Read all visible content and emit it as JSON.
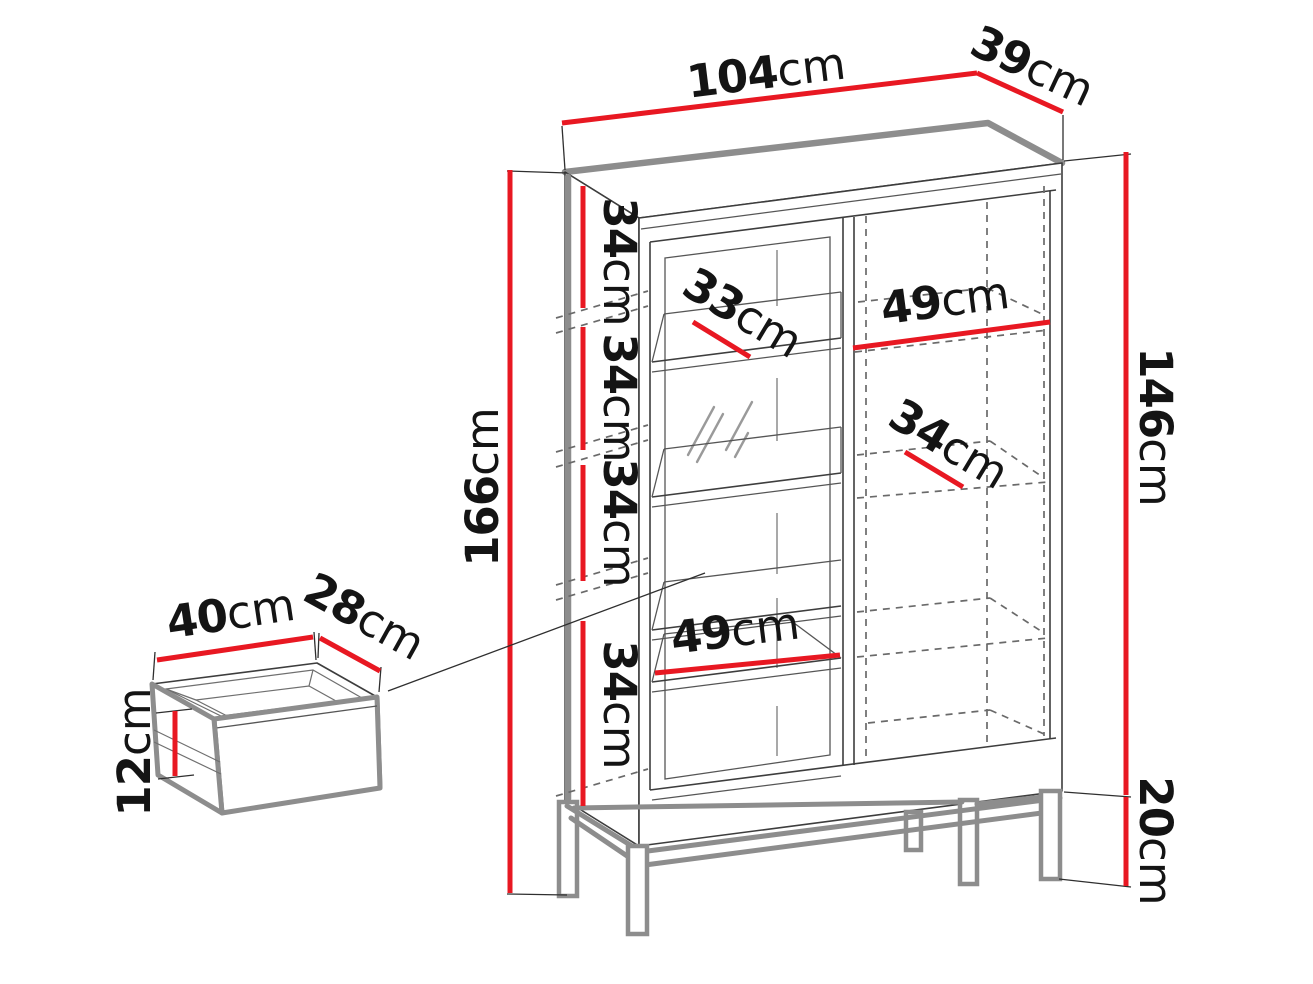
{
  "cabinet": {
    "top_width": {
      "value": "104",
      "unit": "cm"
    },
    "top_depth": {
      "value": "39",
      "unit": "cm"
    },
    "total_height": {
      "value": "166",
      "unit": "cm"
    },
    "body_height": {
      "value": "146",
      "unit": "cm"
    },
    "leg_height": {
      "value": "20",
      "unit": "cm"
    },
    "shelf_sections": [
      {
        "value": "34",
        "unit": "cm"
      },
      {
        "value": "34",
        "unit": "cm"
      },
      {
        "value": "34",
        "unit": "cm"
      },
      {
        "value": "34",
        "unit": "cm"
      }
    ],
    "glass_shelf_depth": {
      "value": "33",
      "unit": "cm"
    },
    "right_shelf_width": {
      "value": "49",
      "unit": "cm"
    },
    "right_shelf_depth": {
      "value": "34",
      "unit": "cm"
    },
    "left_shelf_width": {
      "value": "49",
      "unit": "cm"
    }
  },
  "drawer": {
    "width": {
      "value": "40",
      "unit": "cm"
    },
    "depth": {
      "value": "28",
      "unit": "cm"
    },
    "height": {
      "value": "12",
      "unit": "cm"
    }
  },
  "colors": {
    "dimension_red": "#e81822",
    "outline_dark": "#3d3d3d",
    "edge_gray": "#8d8d8d"
  }
}
